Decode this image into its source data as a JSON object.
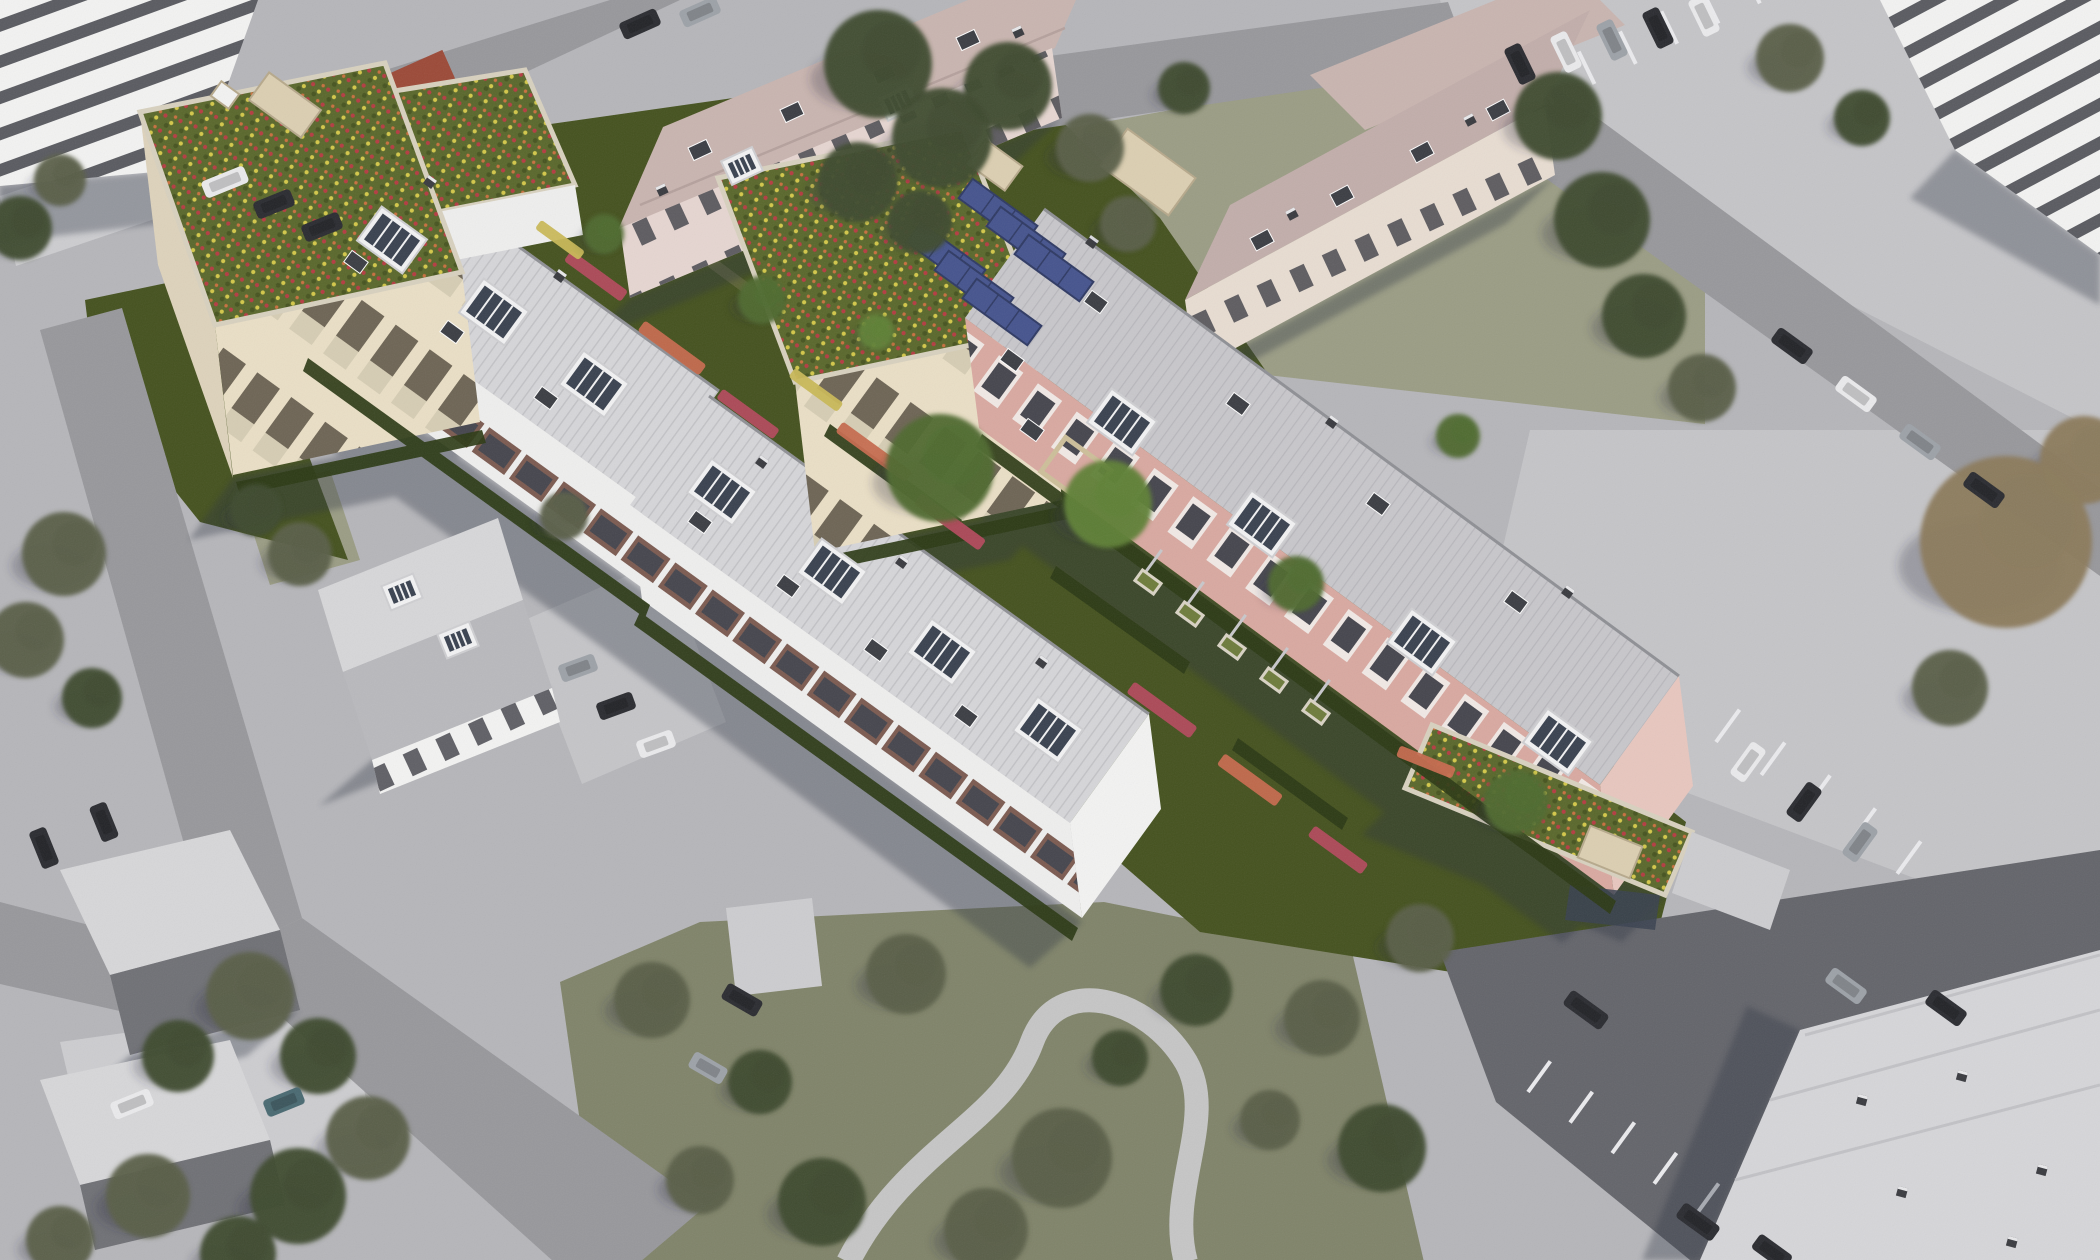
{
  "scene": {
    "description": "Aerial bird's-eye photomontage: new residential buildings with flower green roofs, rooftop solar panels and saturated gardens set inside a desaturated gray aerial photo of an existing neighborhood with roads, parking lots, pitched-roof houses and trees."
  },
  "colors": {
    "bg": "#b6b6ba",
    "road": "#98989c",
    "path_light": "#cdcdd0",
    "apron": "#c5c5c8",
    "asphalt_dark": "#64656b",
    "stall_line": "#ebebee",
    "shadow": "#2c3040",
    "roof_light": "#d6d6d9",
    "roof_line": "#c2c2c6",
    "roof_pink_base": "#c8c7cb",
    "ridge_dark": "#8f9095",
    "mauve_roof": "#c9b5b0",
    "mauve_roof2": "#c2aeab",
    "mauve_facade": "#e6d6d1",
    "cream_facade2": "#e8ddd2",
    "facade_white": "#efefee",
    "balcony_maroon": "#7c5b51",
    "window_dark": "#46464e",
    "facade_cream": "#eadfc6",
    "tower_opening": "#6e6555",
    "balustrade_light": "#d6cdb4",
    "tower_side": "#ded3bc",
    "pink_facade": "#d9a9a1",
    "pink_window_frame": "#f1e9e5",
    "pink_gable": "#e8c7bf",
    "white_wall": "#f3f3f2",
    "gable_white": "#f6f5f1",
    "stripe_dark": "#5a5b61",
    "green_roof_base": "#5a682c",
    "green_roof_dark": "#475420",
    "flower_red": "#b53c42",
    "flower_yellow": "#d4c84a",
    "flower_orange": "#c9703f",
    "garden_green": "#45521f",
    "lawn_olive": "#9b9d85",
    "park_olive": "#80846a",
    "hedge_dark": "#2c3a15",
    "tree_dark": "#3e4a2e",
    "tree_olive": "#5a5f48",
    "tree_green": "#4e6a30",
    "tree_bright": "#5f8036",
    "tree_brown": "#8b7b5c",
    "solar_blue": "#46548e",
    "solar_frame": "#2f3a64",
    "beige_box": "#dccfb2",
    "beige_edge": "#b7a98c",
    "parapet": "#d8d1bf",
    "glass_dark": "#3a4250",
    "car_dark": "#2b2c31",
    "car_white": "#eaeaec",
    "car_silver": "#9da2a8",
    "car_teal": "#4a6a72",
    "red_shed": "#9c4a38",
    "pergola": "#cdbf9a",
    "planter_frame": "#d9d3c4",
    "planter_green": "#6e7c3c",
    "trellis": "#c8c8cb",
    "bed_pink": "#b24a5c",
    "bed_salmon": "#c66a4e",
    "bed_yellow": "#c9b857",
    "dormer_white": "#f2f2f3",
    "dormer_edge": "#cfcfd2",
    "vent_dark": "#3c3e44",
    "dirt_path": "#77754f",
    "house_roof_light": "#d7d7d9",
    "house_roof_dark": "#b9b9bd",
    "house_roof_shade": "#707176"
  },
  "trees": [
    [
      878,
      64,
      54,
      "dark"
    ],
    [
      942,
      138,
      50,
      "dark"
    ],
    [
      1008,
      86,
      44,
      "dark"
    ],
    [
      858,
      182,
      40,
      "dark"
    ],
    [
      920,
      222,
      32,
      "dark"
    ],
    [
      1090,
      148,
      34,
      "olive"
    ],
    [
      1128,
      224,
      28,
      "olive"
    ],
    [
      1184,
      88,
      26,
      "dark"
    ],
    [
      1558,
      116,
      44,
      "dark"
    ],
    [
      1602,
      220,
      48,
      "dark"
    ],
    [
      1644,
      316,
      42,
      "dark"
    ],
    [
      1702,
      388,
      34,
      "olive"
    ],
    [
      1790,
      58,
      34,
      "olive"
    ],
    [
      1862,
      118,
      28,
      "dark"
    ],
    [
      2006,
      542,
      86,
      "brown"
    ],
    [
      2084,
      460,
      44,
      "brown"
    ],
    [
      1950,
      688,
      38,
      "olive"
    ],
    [
      64,
      554,
      42,
      "olive"
    ],
    [
      26,
      640,
      38,
      "olive"
    ],
    [
      92,
      698,
      30,
      "dark"
    ],
    [
      20,
      228,
      32,
      "dark"
    ],
    [
      60,
      180,
      26,
      "olive"
    ],
    [
      250,
      996,
      44,
      "olive"
    ],
    [
      318,
      1056,
      38,
      "dark"
    ],
    [
      178,
      1056,
      36,
      "dark"
    ],
    [
      368,
      1138,
      42,
      "olive"
    ],
    [
      298,
      1196,
      48,
      "dark"
    ],
    [
      148,
      1196,
      42,
      "olive"
    ],
    [
      238,
      1254,
      38,
      "dark"
    ],
    [
      60,
      1240,
      34,
      "olive"
    ],
    [
      300,
      554,
      32,
      "olive"
    ],
    [
      256,
      510,
      26,
      "dark"
    ],
    [
      564,
      516,
      24,
      "olive"
    ],
    [
      652,
      1000,
      38,
      "olive"
    ],
    [
      760,
      1082,
      32,
      "dark"
    ],
    [
      906,
      974,
      40,
      "olive"
    ],
    [
      1062,
      1158,
      50,
      "olive"
    ],
    [
      1196,
      990,
      36,
      "dark"
    ],
    [
      822,
      1202,
      44,
      "dark"
    ],
    [
      700,
      1180,
      34,
      "olive"
    ],
    [
      986,
      1230,
      42,
      "olive"
    ],
    [
      1120,
      1058,
      28,
      "dark"
    ],
    [
      1322,
      1018,
      38,
      "olive"
    ],
    [
      1382,
      1148,
      44,
      "dark"
    ],
    [
      1270,
      1120,
      30,
      "olive"
    ],
    [
      940,
      468,
      54,
      "green"
    ],
    [
      1108,
      504,
      44,
      "bright"
    ],
    [
      762,
      300,
      24,
      "green"
    ],
    [
      1296,
      584,
      28,
      "green"
    ],
    [
      1516,
      802,
      32,
      "green"
    ],
    [
      604,
      234,
      20,
      "green"
    ],
    [
      1458,
      436,
      22,
      "green"
    ],
    [
      876,
      332,
      18,
      "bright"
    ],
    [
      1420,
      938,
      34,
      "olive"
    ]
  ],
  "cars": [
    [
      225,
      182,
      -22,
      "white",
      46
    ],
    [
      274,
      204,
      -22,
      "dark",
      40
    ],
    [
      322,
      227,
      -22,
      "dark",
      40
    ],
    [
      640,
      24,
      -24,
      "dark",
      40
    ],
    [
      700,
      12,
      -24,
      "silver",
      40
    ],
    [
      1520,
      64,
      64,
      "dark",
      40
    ],
    [
      1566,
      52,
      64,
      "white",
      40
    ],
    [
      1612,
      40,
      64,
      "silver",
      40
    ],
    [
      1658,
      28,
      64,
      "dark",
      40
    ],
    [
      1704,
      16,
      64,
      "white",
      40
    ],
    [
      1792,
      346,
      36,
      "dark",
      42
    ],
    [
      1856,
      394,
      36,
      "white",
      42
    ],
    [
      1920,
      442,
      36,
      "silver",
      42
    ],
    [
      1984,
      490,
      36,
      "dark",
      42
    ],
    [
      1748,
      762,
      -54,
      "white",
      40
    ],
    [
      1804,
      802,
      -54,
      "dark",
      40
    ],
    [
      1860,
      842,
      -54,
      "silver",
      40
    ],
    [
      1586,
      1010,
      36,
      "dark",
      46
    ],
    [
      1846,
      986,
      36,
      "silver",
      42
    ],
    [
      1946,
      1008,
      36,
      "dark",
      42
    ],
    [
      1698,
      1222,
      36,
      "dark",
      44
    ],
    [
      1772,
      1252,
      36,
      "dark",
      40
    ],
    [
      44,
      848,
      68,
      "dark",
      40
    ],
    [
      104,
      822,
      68,
      "dark",
      38
    ],
    [
      132,
      1104,
      -22,
      "white",
      42
    ],
    [
      284,
      1102,
      -22,
      "teal",
      40
    ],
    [
      578,
      668,
      -20,
      "silver",
      38
    ],
    [
      616,
      706,
      -20,
      "dark",
      38
    ],
    [
      656,
      744,
      -20,
      "white",
      38
    ],
    [
      742,
      1000,
      30,
      "dark",
      40
    ],
    [
      708,
      1068,
      30,
      "silver",
      38
    ]
  ],
  "flower_beds": [
    [
      596,
      276,
      36,
      70,
      13,
      "bed_pink"
    ],
    [
      672,
      348,
      36,
      76,
      13,
      "bed_salmon"
    ],
    [
      748,
      414,
      36,
      70,
      12,
      "bed_pink"
    ],
    [
      874,
      452,
      36,
      86,
      13,
      "bed_salmon"
    ],
    [
      950,
      522,
      36,
      80,
      13,
      "bed_pink"
    ],
    [
      1162,
      710,
      36,
      78,
      14,
      "bed_pink"
    ],
    [
      1250,
      780,
      36,
      72,
      14,
      "bed_salmon"
    ],
    [
      1338,
      850,
      36,
      66,
      13,
      "bed_pink"
    ],
    [
      816,
      390,
      36,
      60,
      11,
      "bed_yellow"
    ],
    [
      560,
      240,
      36,
      54,
      11,
      "bed_yellow"
    ],
    [
      1426,
      762,
      22,
      60,
      12,
      "bed_salmon"
    ]
  ],
  "planters": [
    [
      1148,
      582
    ],
    [
      1190,
      614
    ],
    [
      1232,
      647
    ],
    [
      1274,
      680
    ],
    [
      1316,
      712
    ]
  ],
  "trellis": [
    [
      1150,
      566
    ],
    [
      1192,
      598
    ],
    [
      1234,
      631
    ],
    [
      1276,
      664
    ],
    [
      1318,
      696
    ]
  ],
  "solar_panels": [
    [
      998,
      212
    ],
    [
      1026,
      240
    ],
    [
      1054,
      268
    ],
    [
      946,
      256
    ],
    [
      974,
      284
    ],
    [
      1002,
      312
    ]
  ],
  "roof_boxes": [
    [
      285,
      105,
      64,
      34,
      36,
      "beige"
    ],
    [
      225,
      95,
      22,
      18,
      36,
      "white"
    ],
    [
      995,
      165,
      46,
      30,
      36,
      "beige"
    ],
    [
      1148,
      172,
      84,
      46,
      36,
      "beige"
    ],
    [
      1610,
      852,
      56,
      34,
      22,
      "beige"
    ]
  ],
  "dormers": {
    "white": [
      [
        392,
        240,
        36,
        "big"
      ],
      [
        494,
        312,
        36,
        "big"
      ],
      [
        594,
        384,
        36,
        "big"
      ],
      [
        722,
        492,
        36,
        "big"
      ],
      [
        832,
        572,
        36,
        "big"
      ],
      [
        942,
        652,
        36,
        "big"
      ],
      [
        1048,
        730,
        36,
        "big"
      ],
      [
        1122,
        422,
        36,
        "big"
      ],
      [
        1262,
        524,
        36,
        "big"
      ],
      [
        1422,
        642,
        36,
        "big"
      ],
      [
        1558,
        742,
        36,
        "big"
      ],
      [
        742,
        166,
        -25,
        "small"
      ],
      [
        898,
        102,
        -25,
        "small"
      ],
      [
        402,
        592,
        -22,
        "small"
      ],
      [
        458,
        640,
        -22,
        "small"
      ]
    ],
    "vents": [
      [
        356,
        262,
        36
      ],
      [
        452,
        332,
        36
      ],
      [
        546,
        398,
        36
      ],
      [
        700,
        522,
        36
      ],
      [
        788,
        586,
        36
      ],
      [
        876,
        650,
        36
      ],
      [
        966,
        716,
        36
      ],
      [
        1096,
        302,
        36
      ],
      [
        1238,
        404,
        36
      ],
      [
        1378,
        504,
        36
      ],
      [
        1516,
        602,
        36
      ],
      [
        1012,
        360,
        36
      ],
      [
        1032,
        430,
        36
      ],
      [
        700,
        150,
        -25
      ],
      [
        792,
        112,
        -25
      ],
      [
        884,
        74,
        -25
      ],
      [
        968,
        40,
        -25
      ],
      [
        1262,
        240,
        -28
      ],
      [
        1342,
        196,
        -28
      ],
      [
        1422,
        152,
        -28
      ],
      [
        1498,
        110,
        -28
      ]
    ],
    "chimneys": [
      [
        430,
        182,
        36
      ],
      [
        560,
        276,
        36
      ],
      [
        762,
        462,
        36
      ],
      [
        902,
        562,
        36
      ],
      [
        1042,
        662,
        36
      ],
      [
        1092,
        242,
        36
      ],
      [
        1332,
        422,
        36
      ],
      [
        1568,
        592,
        36
      ],
      [
        662,
        190,
        -25
      ],
      [
        1018,
        32,
        -25
      ],
      [
        1292,
        214,
        -28
      ],
      [
        1470,
        120,
        -28
      ],
      [
        1862,
        1100,
        15
      ],
      [
        1962,
        1076,
        15
      ],
      [
        2042,
        1170,
        15
      ],
      [
        1902,
        1192,
        15
      ],
      [
        2012,
        1242,
        15
      ]
    ]
  },
  "stall_groups": [
    {
      "x": 1496,
      "y": 92,
      "dir": -26,
      "line": 64,
      "count": 7,
      "gap": 46,
      "len": 36
    },
    {
      "x": 1716,
      "y": 742,
      "dir": 36,
      "line": -54,
      "count": 5,
      "gap": 56,
      "len": 40
    },
    {
      "x": 1528,
      "y": 1092,
      "dir": 36,
      "line": -54,
      "count": 5,
      "gap": 52,
      "len": 38
    }
  ]
}
